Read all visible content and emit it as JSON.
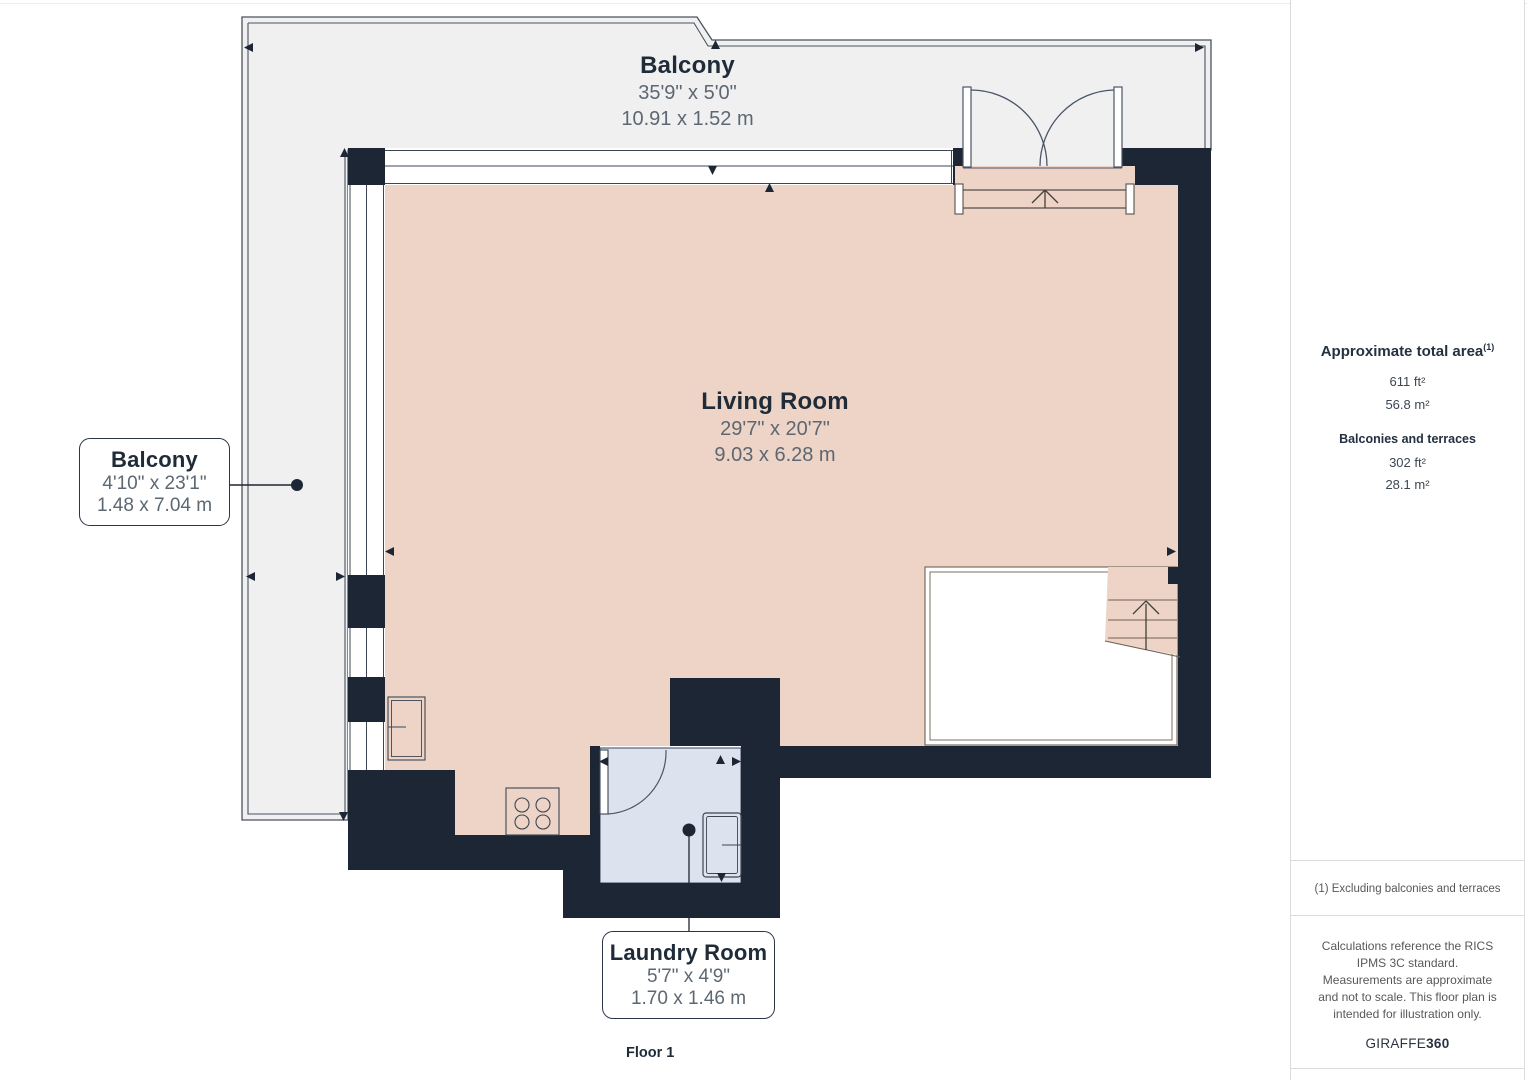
{
  "plan": {
    "floor_label": "Floor 1",
    "rooms": {
      "balcony_top": {
        "name": "Balcony",
        "imperial": "35'9\" x 5'0\"",
        "metric": "10.91 x 1.52 m"
      },
      "balcony_left": {
        "name": "Balcony",
        "imperial": "4'10\" x 23'1\"",
        "metric": "1.48 x 7.04 m"
      },
      "living_room": {
        "name": "Living Room",
        "imperial": "29'7\" x 20'7\"",
        "metric": "9.03 x 6.28 m"
      },
      "laundry_room": {
        "name": "Laundry Room",
        "imperial": "5'7\" x 4'9\"",
        "metric": "1.70 x 1.46 m"
      }
    },
    "colors": {
      "wall": "#1c2634",
      "floor": "#edd4c6",
      "balcony": "#f0f0f1",
      "laundry": "#dce3ee"
    }
  },
  "sidebar": {
    "total_area": {
      "title": "Approximate total area",
      "superscript": "(1)",
      "value_ft": "611 ft²",
      "value_m": "56.8 m²"
    },
    "balconies": {
      "title": "Balconies and terraces",
      "value_ft": "302 ft²",
      "value_m": "28.1 m²"
    },
    "note1": "(1) Excluding balconies and terraces",
    "disclaimer": "Calculations reference the RICS IPMS 3C standard. Measurements are approximate and not to scale. This floor plan is intended for illustration only.",
    "brand": {
      "name": "GIRAFFE",
      "suffix": "360"
    }
  }
}
